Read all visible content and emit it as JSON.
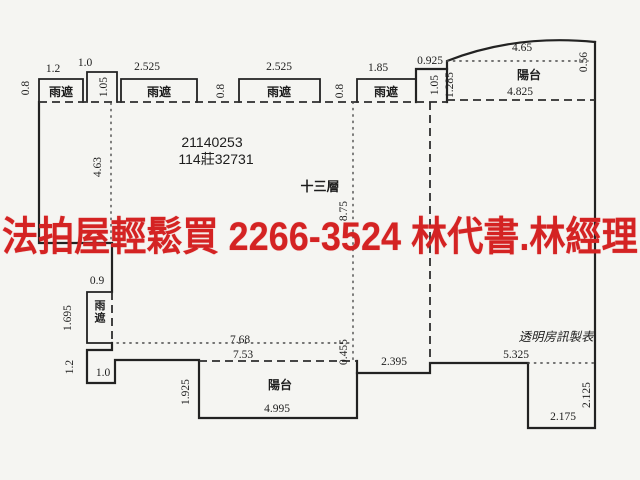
{
  "canvas": {
    "width": 640,
    "height": 480,
    "paper_color": "#f5f5f2",
    "ink_color": "#222222"
  },
  "banner": {
    "text": "法拍屋輕鬆買  2266-3524  林代書.林經理",
    "phone": "2266-3524",
    "color": "#d42323"
  },
  "plan": {
    "registration_number_1": "21140253",
    "registration_number_2": "114莊32731",
    "floor_label": "十三層",
    "publisher_label": "透明房訊製表",
    "canopy_label": "雨遮",
    "balcony_label": "陽台",
    "dimension_labels": [
      {
        "text": "0.8",
        "x": 29,
        "y": 88,
        "rot": -90
      },
      {
        "text": "1.2",
        "x": 53,
        "y": 72
      },
      {
        "text": "1.0",
        "x": 85,
        "y": 66
      },
      {
        "text": "1.05",
        "x": 107,
        "y": 87,
        "rot": -90
      },
      {
        "text": "2.525",
        "x": 147,
        "y": 70
      },
      {
        "text": "0.8",
        "x": 224,
        "y": 91,
        "rot": -90
      },
      {
        "text": "2.525",
        "x": 279,
        "y": 70
      },
      {
        "text": "0.8",
        "x": 343,
        "y": 91,
        "rot": -90
      },
      {
        "text": "1.85",
        "x": 378,
        "y": 71
      },
      {
        "text": "0.925",
        "x": 430,
        "y": 64
      },
      {
        "text": "1.05",
        "x": 438,
        "y": 85,
        "rot": -90
      },
      {
        "text": "1.285",
        "x": 453,
        "y": 85,
        "rot": -90
      },
      {
        "text": "4.65",
        "x": 522,
        "y": 51
      },
      {
        "text": "0.56",
        "x": 587,
        "y": 62,
        "rot": -90
      },
      {
        "text": "4.825",
        "x": 520,
        "y": 95
      },
      {
        "text": "4.63",
        "x": 101,
        "y": 167,
        "rot": -90
      },
      {
        "text": "8.75",
        "x": 347,
        "y": 211,
        "rot": -90
      },
      {
        "text": "0.9",
        "x": 97,
        "y": 284
      },
      {
        "text": "1.695",
        "x": 71,
        "y": 318,
        "rot": -90
      },
      {
        "text": "1.2",
        "x": 73,
        "y": 367,
        "rot": -90
      },
      {
        "text": "1.0",
        "x": 103,
        "y": 376
      },
      {
        "text": "7.68",
        "x": 240,
        "y": 343
      },
      {
        "text": "7.53",
        "x": 243,
        "y": 358
      },
      {
        "text": "1.925",
        "x": 189,
        "y": 392,
        "rot": -90
      },
      {
        "text": "4.995",
        "x": 277,
        "y": 412
      },
      {
        "text": "0.455",
        "x": 347,
        "y": 352,
        "rot": -90
      },
      {
        "text": "2.395",
        "x": 394,
        "y": 365
      },
      {
        "text": "5.325",
        "x": 516,
        "y": 358
      },
      {
        "text": "2.125",
        "x": 590,
        "y": 395,
        "rot": -90
      },
      {
        "text": "2.175",
        "x": 563,
        "y": 420
      }
    ],
    "text_labels": [
      {
        "text": "雨遮",
        "x": 61,
        "y": 96,
        "size": 12,
        "bold": true
      },
      {
        "text": "雨遮",
        "x": 159,
        "y": 96,
        "size": 12,
        "bold": true
      },
      {
        "text": "雨遮",
        "x": 279,
        "y": 96,
        "size": 12,
        "bold": true
      },
      {
        "text": "雨遮",
        "x": 386,
        "y": 96,
        "size": 12,
        "bold": true
      },
      {
        "text": "雨遮",
        "x": 100,
        "y": 309,
        "size": 11,
        "bold": true,
        "stack": true
      },
      {
        "text": "陽台",
        "x": 529,
        "y": 79,
        "size": 12,
        "bold": true
      },
      {
        "text": "陽台",
        "x": 280,
        "y": 389,
        "size": 12,
        "bold": true
      },
      {
        "text": "21140253",
        "x": 212,
        "y": 147,
        "size": 14
      },
      {
        "text": "114莊32731",
        "x": 216,
        "y": 164,
        "size": 14
      },
      {
        "text": "十三層",
        "x": 320,
        "y": 191,
        "size": 13,
        "bold": true
      },
      {
        "text": "透明房訊製表",
        "x": 556,
        "y": 341,
        "size": 12.5,
        "italic": true
      }
    ]
  }
}
